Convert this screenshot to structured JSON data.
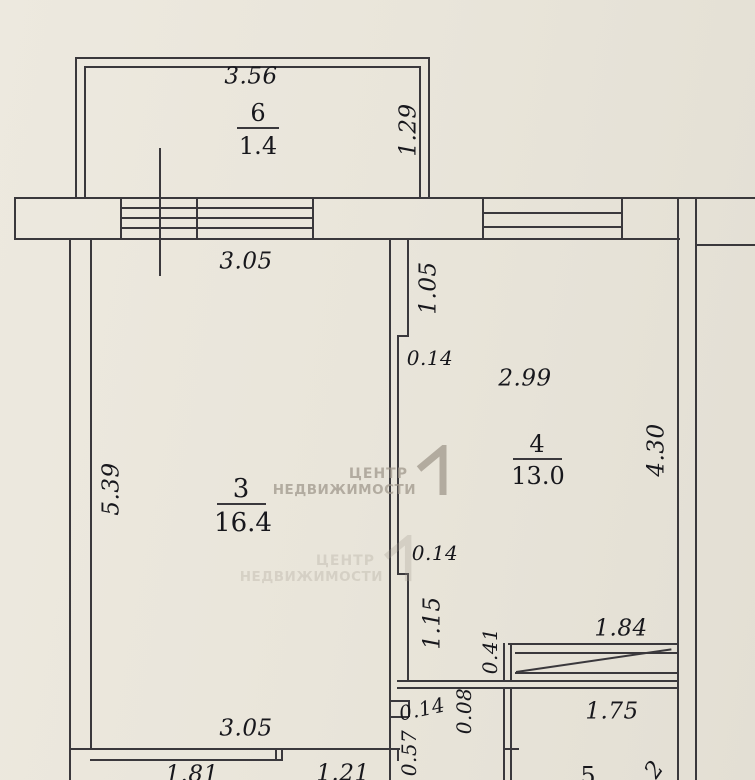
{
  "plan": {
    "balcony": {
      "number": "6",
      "area": "1.4",
      "width": "3.56",
      "depth": "1.29"
    },
    "room3": {
      "number": "3",
      "area": "16.4",
      "width_top": "3.05",
      "height_left": "5.39",
      "width_bottom": "3.05"
    },
    "room4": {
      "number": "4",
      "area": "13.0",
      "width": "2.99",
      "height_right": "4.30"
    },
    "room5": {
      "number": "5",
      "width": "1.75",
      "dim_partial": "2"
    },
    "walls": {
      "seg_105": "1.05",
      "jog_top": "0.14",
      "jog_mid": "0.14",
      "seg_115": "1.15",
      "stub": "0.41",
      "door_width": "1.84",
      "seg_008": "0.08",
      "jog_bottom": "0.14",
      "seg_057": "0.57",
      "bottom_left": "1.81",
      "bottom_mid": "1.21"
    },
    "watermark": {
      "line1": "ЦЕНТР",
      "line2": "НЕДВИЖИМОСТИ"
    }
  },
  "colors": {
    "paper": "#e9e5da",
    "line": "#3a383c",
    "text": "#17171c",
    "watermark": "#9e968a"
  }
}
